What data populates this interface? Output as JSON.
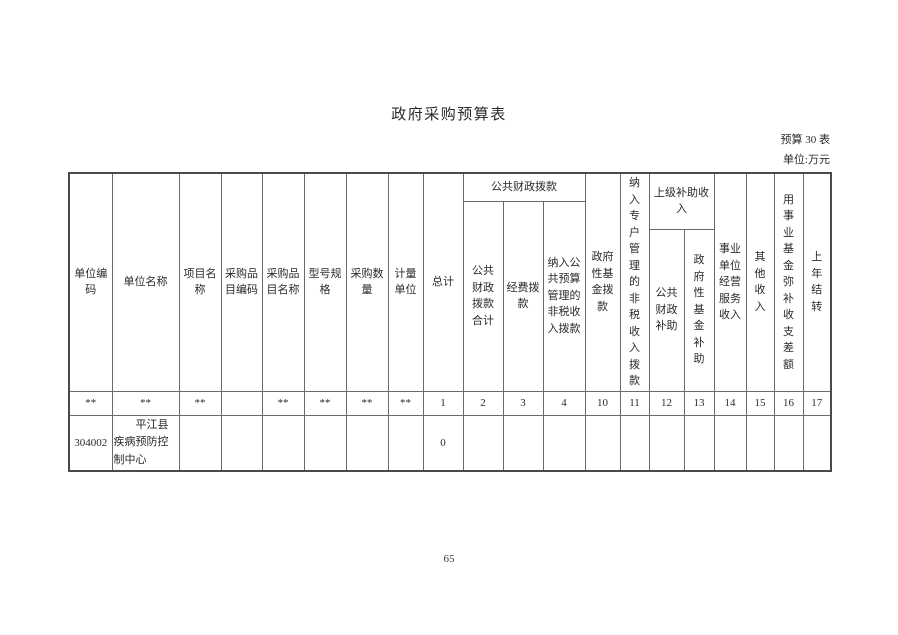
{
  "page": {
    "title": "政府采购预算表",
    "table_ref": "预算 30 表",
    "unit_note": "单位:万元",
    "page_number": "65"
  },
  "table": {
    "headers": {
      "unit_code": "单位编码",
      "unit_name": "单位名称",
      "project_name": "项目名称",
      "item_code": "采购品目编码",
      "item_name": "采购品目名称",
      "model_spec": "型号规格",
      "purchase_qty": "采购数量",
      "measure_unit": "计量单位",
      "total": "总计",
      "public_finance_group": "公共财政拨款",
      "public_finance_total": "公共财政拨款合计",
      "funding_allocation": "经费拨款",
      "nontax_public_budget": "纳入公共预算管理的非税收入拨款",
      "gov_fund": "政府性基金拨款",
      "nontax_special_account": "纳入专户管理的非税收入拨款",
      "superior_subsidy_group": "上级补助收入",
      "public_finance_subsidy": "公共财政补助",
      "gov_fund_subsidy": "政府性基金补助",
      "operating_income": "事业单位经营服务收入",
      "other_income": "其他收入",
      "fund_balance": "用事业基金弥补收支差额",
      "carryover": "上年结转"
    },
    "number_row": [
      "**",
      "**",
      "**",
      "",
      "**",
      "**",
      "**",
      "**",
      "1",
      "2",
      "3",
      "4",
      "10",
      "11",
      "12",
      "13",
      "14",
      "15",
      "16",
      "17"
    ],
    "row": {
      "unit_code": "304002",
      "unit_name": "平江县疾病预防控制中心",
      "project_name": "",
      "item_code": "",
      "item_name": "",
      "model_spec": "",
      "purchase_qty": "",
      "measure_unit": "",
      "total": "0",
      "public_finance_total": "",
      "funding_allocation": "",
      "nontax_public_budget": "",
      "gov_fund": "",
      "nontax_special_account": "",
      "public_finance_subsidy": "",
      "gov_fund_subsidy": "",
      "operating_income": "",
      "other_income": "",
      "fund_balance": "",
      "carryover": ""
    }
  }
}
